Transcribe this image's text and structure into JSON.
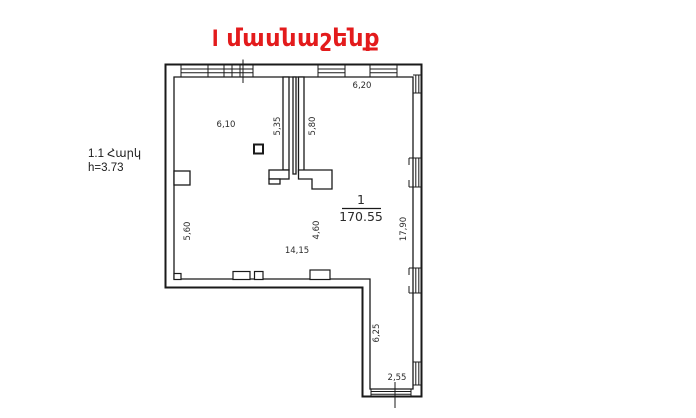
{
  "title": {
    "text": "I մասնաշենք",
    "color": "#e31b1c"
  },
  "floor_info": {
    "line1": "1.1 Հարկ",
    "line2": "h=3.73"
  },
  "room": {
    "number": "1",
    "area": "170.55"
  },
  "dimensions": {
    "top_left_room_width": "6,10",
    "partition_left_height": "5,35",
    "partition_right_height": "5,80",
    "top_right_room_width": "6,20",
    "left_wall_height": "5,60",
    "mid_height": "4,60",
    "hall_width": "14,15",
    "right_wall_height": "17,90",
    "corridor_height": "6,25",
    "corridor_width": "2,55"
  },
  "colors": {
    "wall_line": "#1a1a1a",
    "background": "#ffffff"
  }
}
